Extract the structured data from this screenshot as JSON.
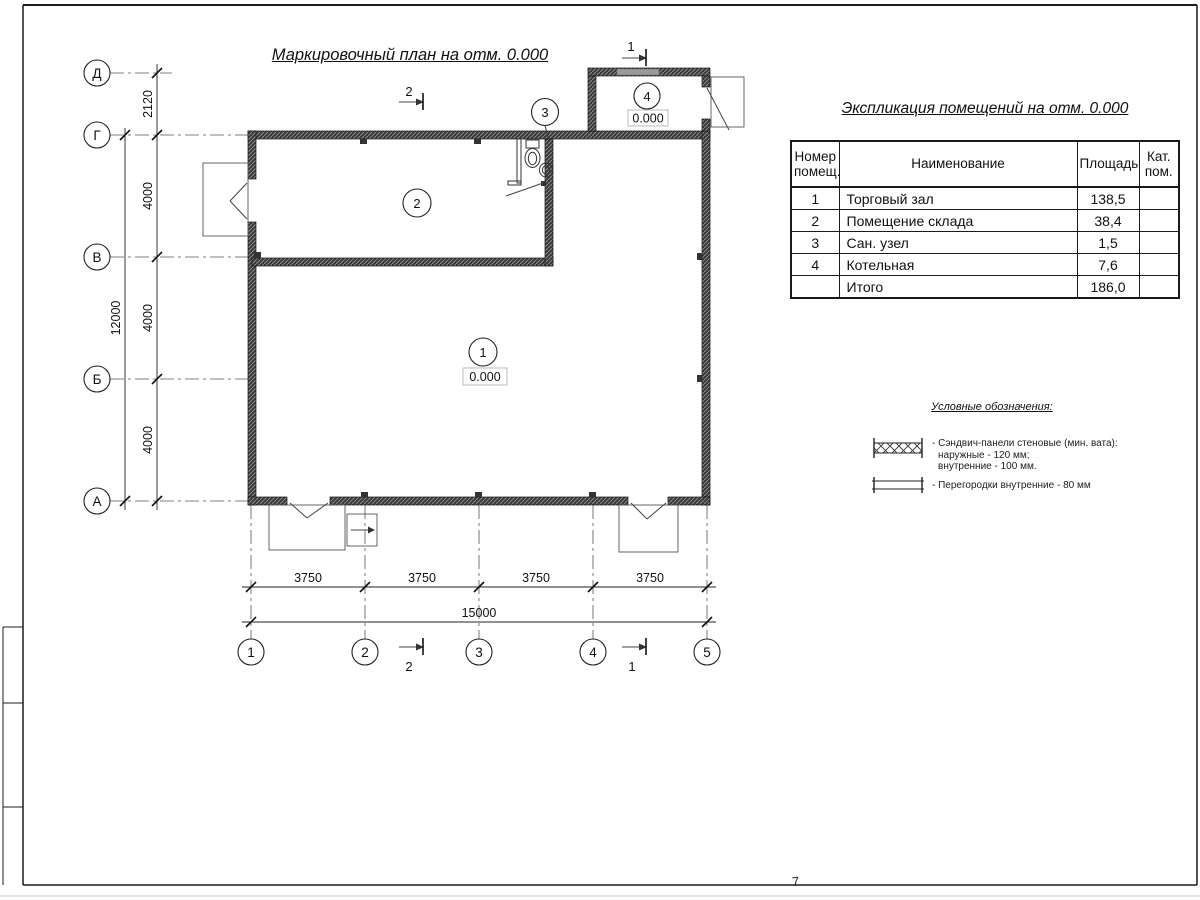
{
  "sheet": {
    "plan_title": "Маркировочный план на отм. 0.000",
    "table_title": "Экспликация помещений на отм. 0.000",
    "page_number": "7"
  },
  "axes": {
    "left": [
      "Д",
      "Г",
      "В",
      "Б",
      "А"
    ],
    "bottom": [
      "1",
      "2",
      "3",
      "4",
      "5"
    ]
  },
  "dims": {
    "left_segments": [
      "2120",
      "4000",
      "4000",
      "4000"
    ],
    "left_total": "12000",
    "bottom_segments": [
      "3750",
      "3750",
      "3750",
      "3750"
    ],
    "bottom_total": "15000"
  },
  "rooms": {
    "r1": {
      "number": "1",
      "elevation": "0.000"
    },
    "r2": {
      "number": "2"
    },
    "r3": {
      "number": "3"
    },
    "r4": {
      "number": "4",
      "elevation": "0.000"
    }
  },
  "sections": {
    "s1": "1",
    "s2": "2"
  },
  "table": {
    "headers": {
      "num": "Номер помещ.",
      "name": "Наименование",
      "area": "Площадь",
      "cat": "Кат. пом."
    },
    "rows": [
      {
        "num": "1",
        "name": "Торговый зал",
        "area": "138,5",
        "cat": ""
      },
      {
        "num": "2",
        "name": "Помещение склада",
        "area": "38,4",
        "cat": ""
      },
      {
        "num": "3",
        "name": "Сан. узел",
        "area": "1,5",
        "cat": ""
      },
      {
        "num": "4",
        "name": "Котельная",
        "area": "7,6",
        "cat": ""
      },
      {
        "num": "",
        "name": "Итого",
        "area": "186,0",
        "cat": ""
      }
    ]
  },
  "legend": {
    "title": "Условные обозначения:",
    "items": [
      {
        "symbol": "sandwich-panel-hatch",
        "lines": [
          "- Сэндвич-панели стеновые (мин. вата):",
          "наружные - 120 мм;",
          "внутренние - 100 мм."
        ]
      },
      {
        "symbol": "internal-partition",
        "lines": [
          "- Перегородки внутренние - 80 мм"
        ]
      }
    ]
  },
  "colors": {
    "line": "#1a1a1a",
    "wall": "#3a3a3a",
    "window": "#9a9a9a",
    "paper": "#ffffff"
  }
}
